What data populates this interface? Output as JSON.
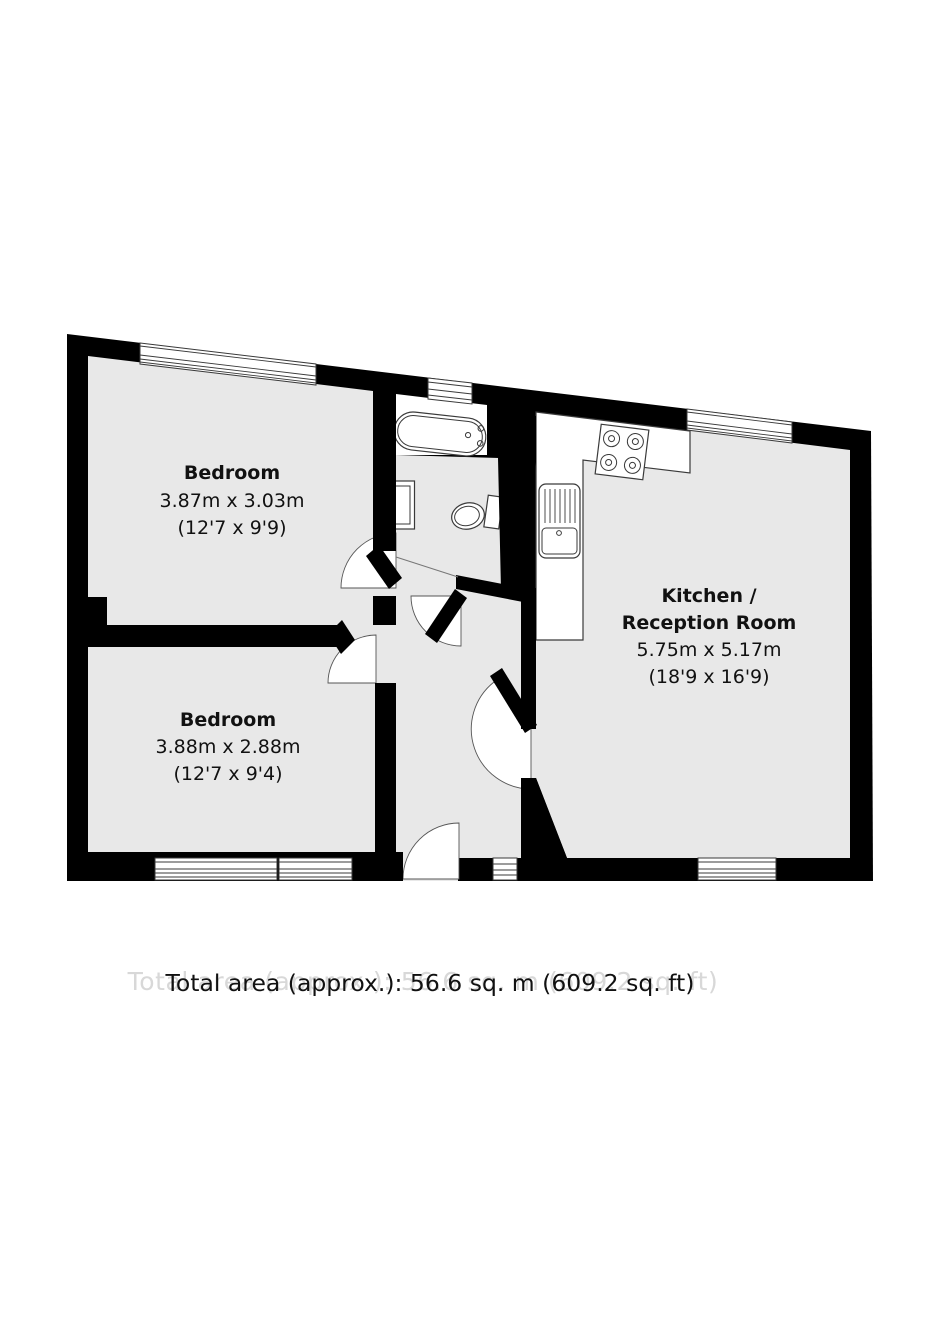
{
  "floorplan": {
    "rooms": [
      {
        "id": "bedroom-1",
        "name": "Bedroom",
        "metric": "3.87m x 3.03m",
        "imperial": "(12'7 x 9'9)"
      },
      {
        "id": "bedroom-2",
        "name": "Bedroom",
        "metric": "3.88m x 2.88m",
        "imperial": "(12'7 x 9'4)"
      },
      {
        "id": "kitchen-reception",
        "name_line1": "Kitchen /",
        "name_line2": "Reception Room",
        "metric": "5.75m x 5.17m",
        "imperial": "(18'9 x 16'9)"
      }
    ],
    "total_area_label": "Total area (approx.): 56.6 sq. m (609.2 sq. ft)",
    "fixtures": [
      "bath",
      "wash-basin",
      "toilet",
      "kitchen-sink-drainer",
      "hob-4-burner"
    ],
    "window_count": 7,
    "colors": {
      "wall": "#000000",
      "floor": "#e8e8e8",
      "fixture_fill": "#ffffff",
      "outline": "#3a3a3a",
      "text": "#111111",
      "ghost_text": "#d8d8d8"
    }
  }
}
